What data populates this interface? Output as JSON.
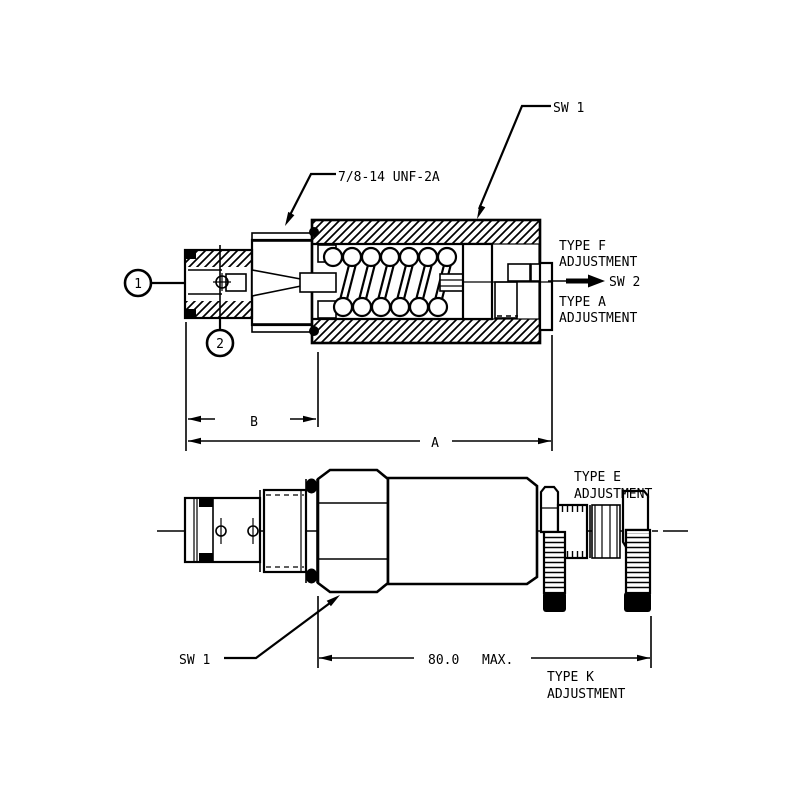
{
  "drawing": {
    "background": "#ffffff",
    "line_color": "#000000",
    "callouts": {
      "balloon_1": "1",
      "balloon_2": "2",
      "thread_spec": "7/8-14 UNF-2A",
      "sw1_top": "SW 1",
      "sw2": "SW 2",
      "sw1_bottom": "SW 1"
    },
    "adjustments": {
      "type_f": {
        "line1": "TYPE F",
        "line2": "ADJUSTMENT"
      },
      "type_a": {
        "line1": "TYPE A",
        "line2": "ADJUSTMENT"
      },
      "type_e": {
        "line1": "TYPE E",
        "line2": "ADJUSTMENT"
      },
      "type_k": {
        "line1": "TYPE K",
        "line2": "ADJUSTMENT"
      }
    },
    "dimensions": {
      "a": "A",
      "b": "B",
      "length_value": "80.0",
      "length_suffix": "MAX."
    }
  }
}
